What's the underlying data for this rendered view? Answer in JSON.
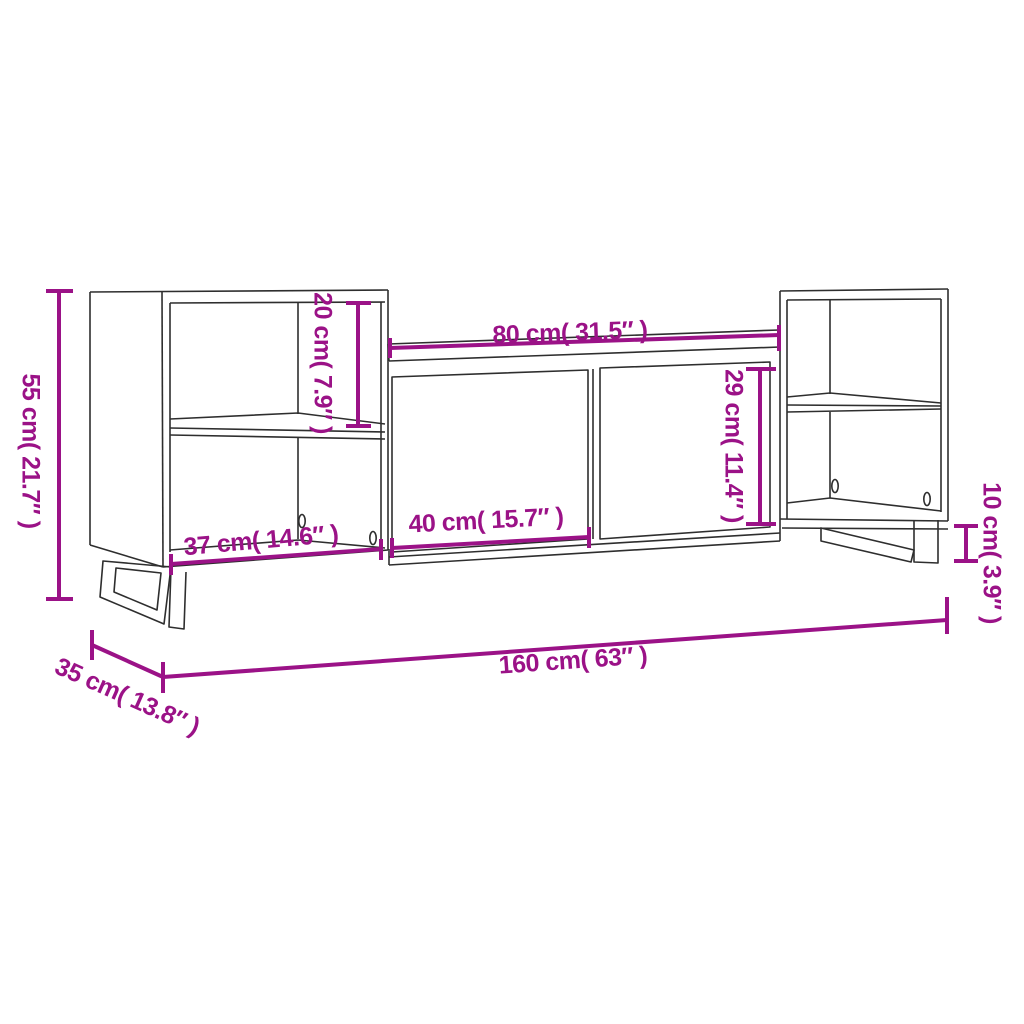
{
  "diagram": {
    "subject": "tv-cabinet-dimension-drawing",
    "colors": {
      "background": "#ffffff",
      "outline": "#2e2e2e",
      "dimension": "#9b1287"
    }
  },
  "dimension_labels": {
    "overall_height": "55 cm( 21.7″ )",
    "upper_shelf_height": "20 cm( 7.9″ )",
    "center_top_width": "80 cm( 31.5″ )",
    "door_height": "29 cm( 11.4″ )",
    "side_shelf_width": "37 cm( 14.6″ )",
    "door_width": "40 cm( 15.7″ )",
    "leg_height": "10 cm( 3.9″ )",
    "overall_width": "160 cm( 63″ )",
    "depth": "35 cm( 13.8″ )"
  }
}
